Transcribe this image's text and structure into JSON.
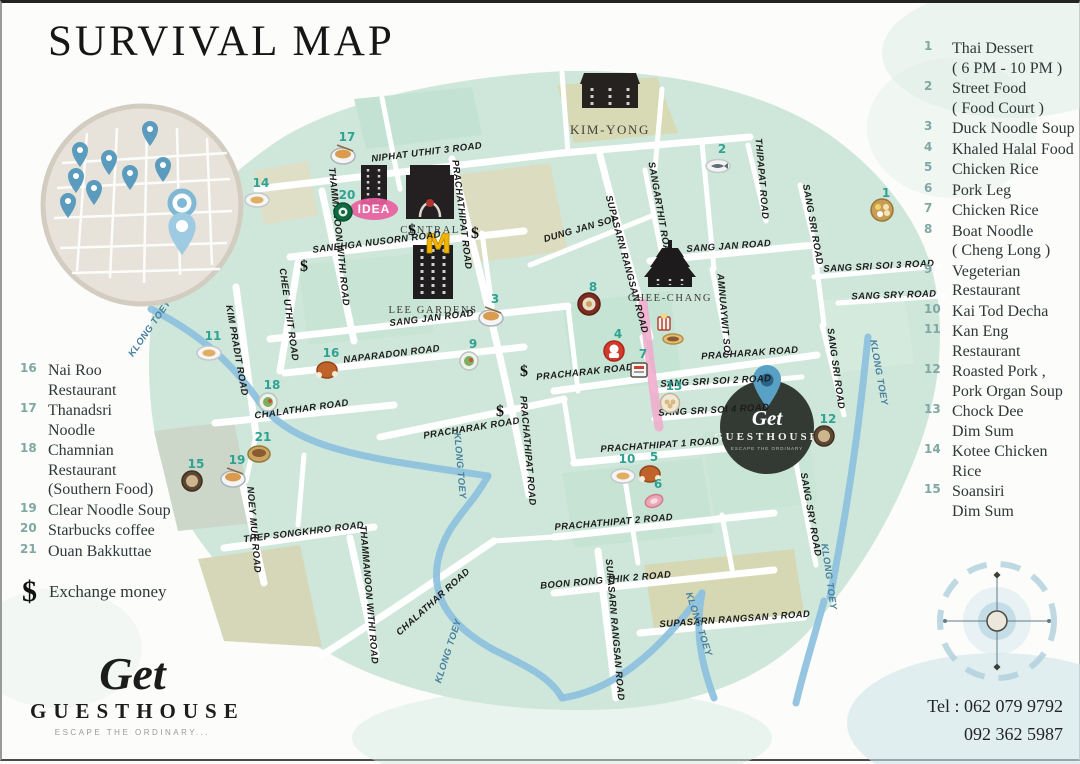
{
  "title": "SURVIVAL MAP",
  "legend_right": [
    {
      "num": "1",
      "text": "Thai Dessert\n( 6 PM - 10 PM )"
    },
    {
      "num": "2",
      "text": "Street Food\n( Food Court )"
    },
    {
      "num": "3",
      "text": "Duck Noodle Soup"
    },
    {
      "num": "4",
      "text": "Khaled Halal Food"
    },
    {
      "num": "5",
      "text": "Chicken Rice"
    },
    {
      "num": "6",
      "text": "Pork Leg"
    },
    {
      "num": "7",
      "text": "Chicken Rice"
    },
    {
      "num": "8",
      "text": "Boat Noodle\n( Cheng Long )"
    },
    {
      "num": "9",
      "text": "Vegeterian\nRestaurant"
    },
    {
      "num": "10",
      "text": "Kai Tod Decha"
    },
    {
      "num": "11",
      "text": "Kan Eng\nRestaurant"
    },
    {
      "num": "12",
      "text": "Roasted Pork ,\nPork Organ Soup"
    },
    {
      "num": "13",
      "text": "Chock Dee\nDim Sum"
    },
    {
      "num": "14",
      "text": "Kotee Chicken\nRice"
    },
    {
      "num": "15",
      "text": "Soansiri\nDim Sum"
    }
  ],
  "legend_left": [
    {
      "num": "16",
      "text": "Nai Roo\nRestaurant"
    },
    {
      "num": "17",
      "text": "Thanadsri\nNoodle"
    },
    {
      "num": "18",
      "text": "Chamnian\nRestaurant\n(Southern Food)"
    },
    {
      "num": "19",
      "text": "Clear Noodle Soup"
    },
    {
      "num": "20",
      "text": "Starbucks coffee"
    },
    {
      "num": "21",
      "text": "Ouan Bakkuttae"
    }
  ],
  "exchange": {
    "symbol": "$",
    "label": "Exchange money"
  },
  "logo": {
    "script": "Get",
    "name": "GUESTHOUSE",
    "tagline": "ESCAPE THE ORDINARY..."
  },
  "contact": {
    "line1": "Tel : 062 079 9792",
    "line2": "092 362 5987"
  },
  "colors": {
    "accent_teal": "#2fa392",
    "map_green": "#cfe7db",
    "water_blue": "#8fc2de",
    "pink": "#ef5f9f",
    "dark_building": "#242021"
  },
  "map": {
    "landmarks": {
      "kim_yong": "KIM-YONG",
      "idea": "IDEA",
      "central": "CENTRAL",
      "mcdonalds": "M",
      "lee_gardens": "LEE GARDENS",
      "chee_chang": "CHEE-CHANG"
    },
    "guesthouse": {
      "script": "Get",
      "name": "GUESTHOUSE",
      "tagline": "ESCAPE THE ORDINARY"
    },
    "road_labels": [
      {
        "t": "NIPHAT UTHIT 3 ROAD",
        "x": 425,
        "y": 152,
        "r": -7
      },
      {
        "t": "PRACHATHIPAT ROAD",
        "x": 457,
        "y": 212,
        "r": 83
      },
      {
        "t": "SANEHGA NUSORN ROAD",
        "x": 375,
        "y": 242,
        "r": -7
      },
      {
        "t": "THAMMANOON WITHI ROAD",
        "x": 334,
        "y": 234,
        "r": 84
      },
      {
        "t": "DUNG JAN SOI",
        "x": 578,
        "y": 229,
        "r": -16
      },
      {
        "t": "SUPASARN RANGSAN ROAD",
        "x": 622,
        "y": 262,
        "r": 75
      },
      {
        "t": "SANGARTHIT ROAD",
        "x": 655,
        "y": 208,
        "r": 80
      },
      {
        "t": "THIPAPAT ROAD",
        "x": 757,
        "y": 176,
        "r": 85
      },
      {
        "t": "SANG SRI ROAD",
        "x": 808,
        "y": 222,
        "r": 80
      },
      {
        "t": "SANG JAN ROAD",
        "x": 727,
        "y": 246,
        "r": -4
      },
      {
        "t": "SANG SRI SOI 3 ROAD",
        "x": 877,
        "y": 266,
        "r": -3
      },
      {
        "t": "SANG SRY ROAD",
        "x": 892,
        "y": 295,
        "r": -2
      },
      {
        "t": "SANG JAN ROAD",
        "x": 430,
        "y": 318,
        "r": -7
      },
      {
        "t": "NAPARADON ROAD",
        "x": 390,
        "y": 354,
        "r": -7
      },
      {
        "t": "CHEE UTHIT ROAD",
        "x": 284,
        "y": 312,
        "r": 82
      },
      {
        "t": "KIM PRADIT ROAD",
        "x": 232,
        "y": 348,
        "r": 80
      },
      {
        "t": "PRACHARAK ROAD",
        "x": 583,
        "y": 372,
        "r": -6
      },
      {
        "t": "PRACHARAK ROAD",
        "x": 748,
        "y": 353,
        "r": -4
      },
      {
        "t": "AMNUAYWIT SOI",
        "x": 719,
        "y": 312,
        "r": 85
      },
      {
        "t": "SANG SRI SOI 2 ROAD",
        "x": 714,
        "y": 381,
        "r": -3
      },
      {
        "t": "SANG SRI SOI 4 ROAD",
        "x": 712,
        "y": 410,
        "r": -3
      },
      {
        "t": "SANG SRI ROAD",
        "x": 831,
        "y": 366,
        "r": 82
      },
      {
        "t": "CHALATHAR ROAD",
        "x": 300,
        "y": 409,
        "r": -8
      },
      {
        "t": "PRACHARAK ROAD",
        "x": 470,
        "y": 428,
        "r": -9
      },
      {
        "t": "PRACHATHIPAT ROAD",
        "x": 523,
        "y": 448,
        "r": 85
      },
      {
        "t": "PRACHATHIPAT 1 ROAD",
        "x": 658,
        "y": 445,
        "r": -4
      },
      {
        "t": "NOEY MUK ROAD",
        "x": 249,
        "y": 527,
        "r": 85
      },
      {
        "t": "THEP SONGKHRO ROAD",
        "x": 302,
        "y": 532,
        "r": -7
      },
      {
        "t": "THAMMANOON WITHI ROAD",
        "x": 364,
        "y": 592,
        "r": 85
      },
      {
        "t": "CHALATHAR ROAD",
        "x": 433,
        "y": 601,
        "r": -42
      },
      {
        "t": "PRACHATHIPAT 2 ROAD",
        "x": 612,
        "y": 522,
        "r": -5
      },
      {
        "t": "BOON RONG THIK 2 ROAD",
        "x": 604,
        "y": 580,
        "r": -5
      },
      {
        "t": "SUPASARN RANGSAN ROAD",
        "x": 610,
        "y": 627,
        "r": 85
      },
      {
        "t": "SUPASARN RANGSAN 3 ROAD",
        "x": 733,
        "y": 619,
        "r": -4
      },
      {
        "t": "SANG SRY ROAD",
        "x": 806,
        "y": 512,
        "r": 80
      },
      {
        "t": "KLONG TOEY",
        "x": 150,
        "y": 327,
        "r": -55,
        "c": 1
      },
      {
        "t": "KLONG TOEY",
        "x": 455,
        "y": 463,
        "r": 85,
        "c": 1
      },
      {
        "t": "KLONG TOEY",
        "x": 449,
        "y": 649,
        "r": -72,
        "c": 1
      },
      {
        "t": "KLONG TOEY",
        "x": 694,
        "y": 622,
        "r": 72,
        "c": 1
      },
      {
        "t": "KLONG TOEY",
        "x": 824,
        "y": 574,
        "r": 82,
        "c": 1
      },
      {
        "t": "KLONG TOEY",
        "x": 874,
        "y": 370,
        "r": 80,
        "c": 1
      }
    ],
    "dollars": [
      [
        410,
        232
      ],
      [
        473,
        235
      ],
      [
        302,
        268
      ],
      [
        522,
        373
      ],
      [
        498,
        413
      ]
    ],
    "markers": [
      {
        "n": "17",
        "x": 341,
        "y": 151,
        "k": "noodle"
      },
      {
        "n": "14",
        "x": 255,
        "y": 197,
        "k": "plate"
      },
      {
        "n": "20",
        "x": 341,
        "y": 209,
        "k": "starbucks"
      },
      {
        "n": "3",
        "x": 489,
        "y": 313,
        "k": "noodle"
      },
      {
        "n": "8",
        "x": 587,
        "y": 301,
        "k": "tray"
      },
      {
        "n": "9",
        "x": 467,
        "y": 358,
        "k": "salad"
      },
      {
        "n": "16",
        "x": 325,
        "y": 367,
        "k": "chicken"
      },
      {
        "n": "11",
        "x": 207,
        "y": 350,
        "k": "plate"
      },
      {
        "n": "18",
        "x": 266,
        "y": 399,
        "k": "salad"
      },
      {
        "n": "15",
        "x": 190,
        "y": 478,
        "k": "bowl"
      },
      {
        "n": "19",
        "x": 231,
        "y": 474,
        "k": "noodle"
      },
      {
        "n": "21",
        "x": 257,
        "y": 451,
        "k": "pot"
      },
      {
        "n": "4",
        "x": 612,
        "y": 348,
        "k": "chef"
      },
      {
        "n": "7",
        "x": 637,
        "y": 368,
        "k": "sign"
      },
      {
        "n": "13",
        "x": 668,
        "y": 400,
        "k": "dimsum"
      },
      {
        "n": "2",
        "x": 716,
        "y": 163,
        "k": "fish"
      },
      {
        "n": "1",
        "x": 880,
        "y": 207,
        "k": "dessert"
      },
      {
        "n": "12",
        "x": 822,
        "y": 433,
        "k": "bowl"
      },
      {
        "n": "10",
        "x": 621,
        "y": 473,
        "k": "plate"
      },
      {
        "n": "5",
        "x": 648,
        "y": 471,
        "k": "chicken"
      },
      {
        "n": "6",
        "x": 652,
        "y": 498,
        "k": "meat"
      },
      {
        "n": "",
        "x": 662,
        "y": 321,
        "k": "popcorn"
      },
      {
        "n": "",
        "x": 671,
        "y": 336,
        "k": "sandwich"
      }
    ]
  }
}
